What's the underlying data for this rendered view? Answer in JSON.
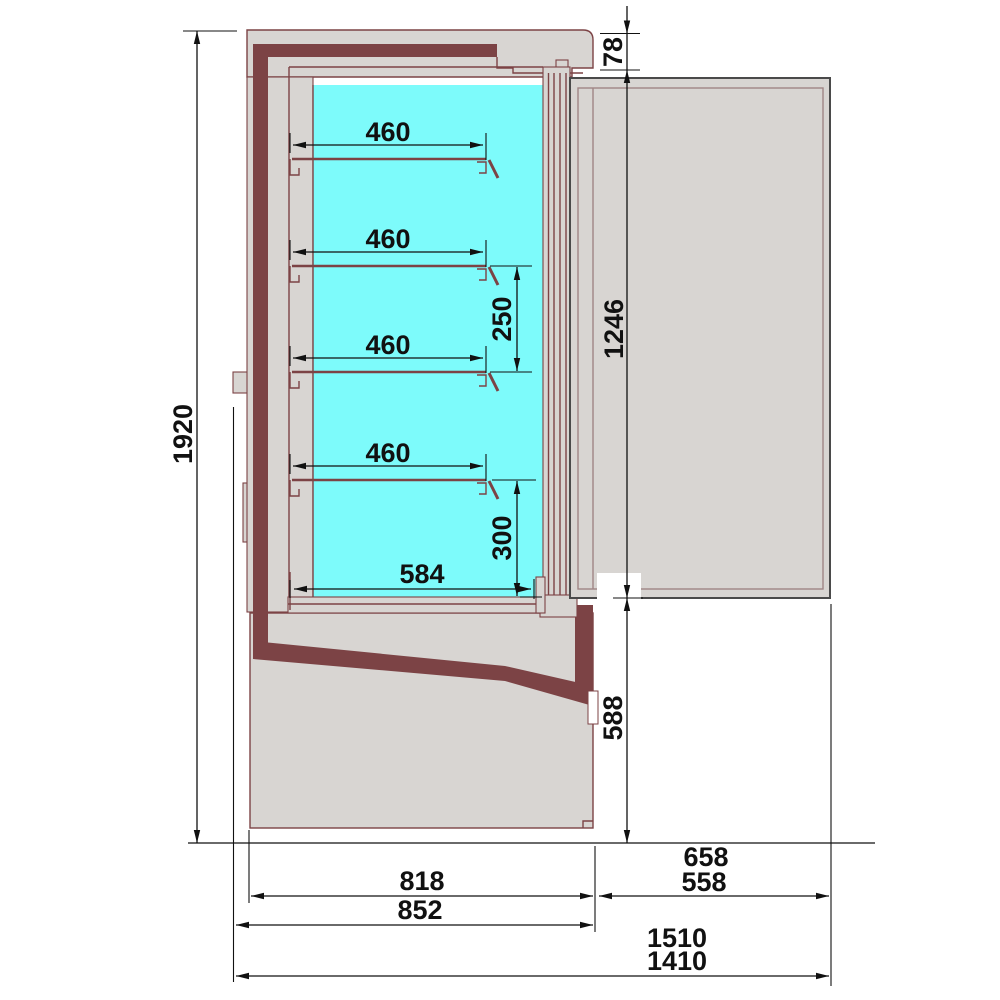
{
  "drawing": {
    "kind": "refrigerated-display-cabinet-side-section",
    "units_note": ""
  },
  "dimensions": {
    "overall_height": "1920",
    "top_gap": "78",
    "shelf_depths": [
      "460",
      "460",
      "460",
      "460"
    ],
    "shelf_pitch": "250",
    "bottom_shelf_pitch": "300",
    "base_shelf_depth": "584",
    "door_height": "1246",
    "base_height": "588",
    "body_depth": "818",
    "body_depth_overall": "852",
    "door_width_outer": "658",
    "door_width": "558",
    "overall_depth_door_open_max": "1510",
    "overall_depth_door_open": "1410"
  },
  "colors": {
    "glass": "#7DFBFB",
    "body": "#D8D5D2",
    "insulation": "#7C4345",
    "outline": "#7C4345",
    "door_outline": "#4A4A4A",
    "dimension": "#111111",
    "background": "#FFFFFF"
  }
}
